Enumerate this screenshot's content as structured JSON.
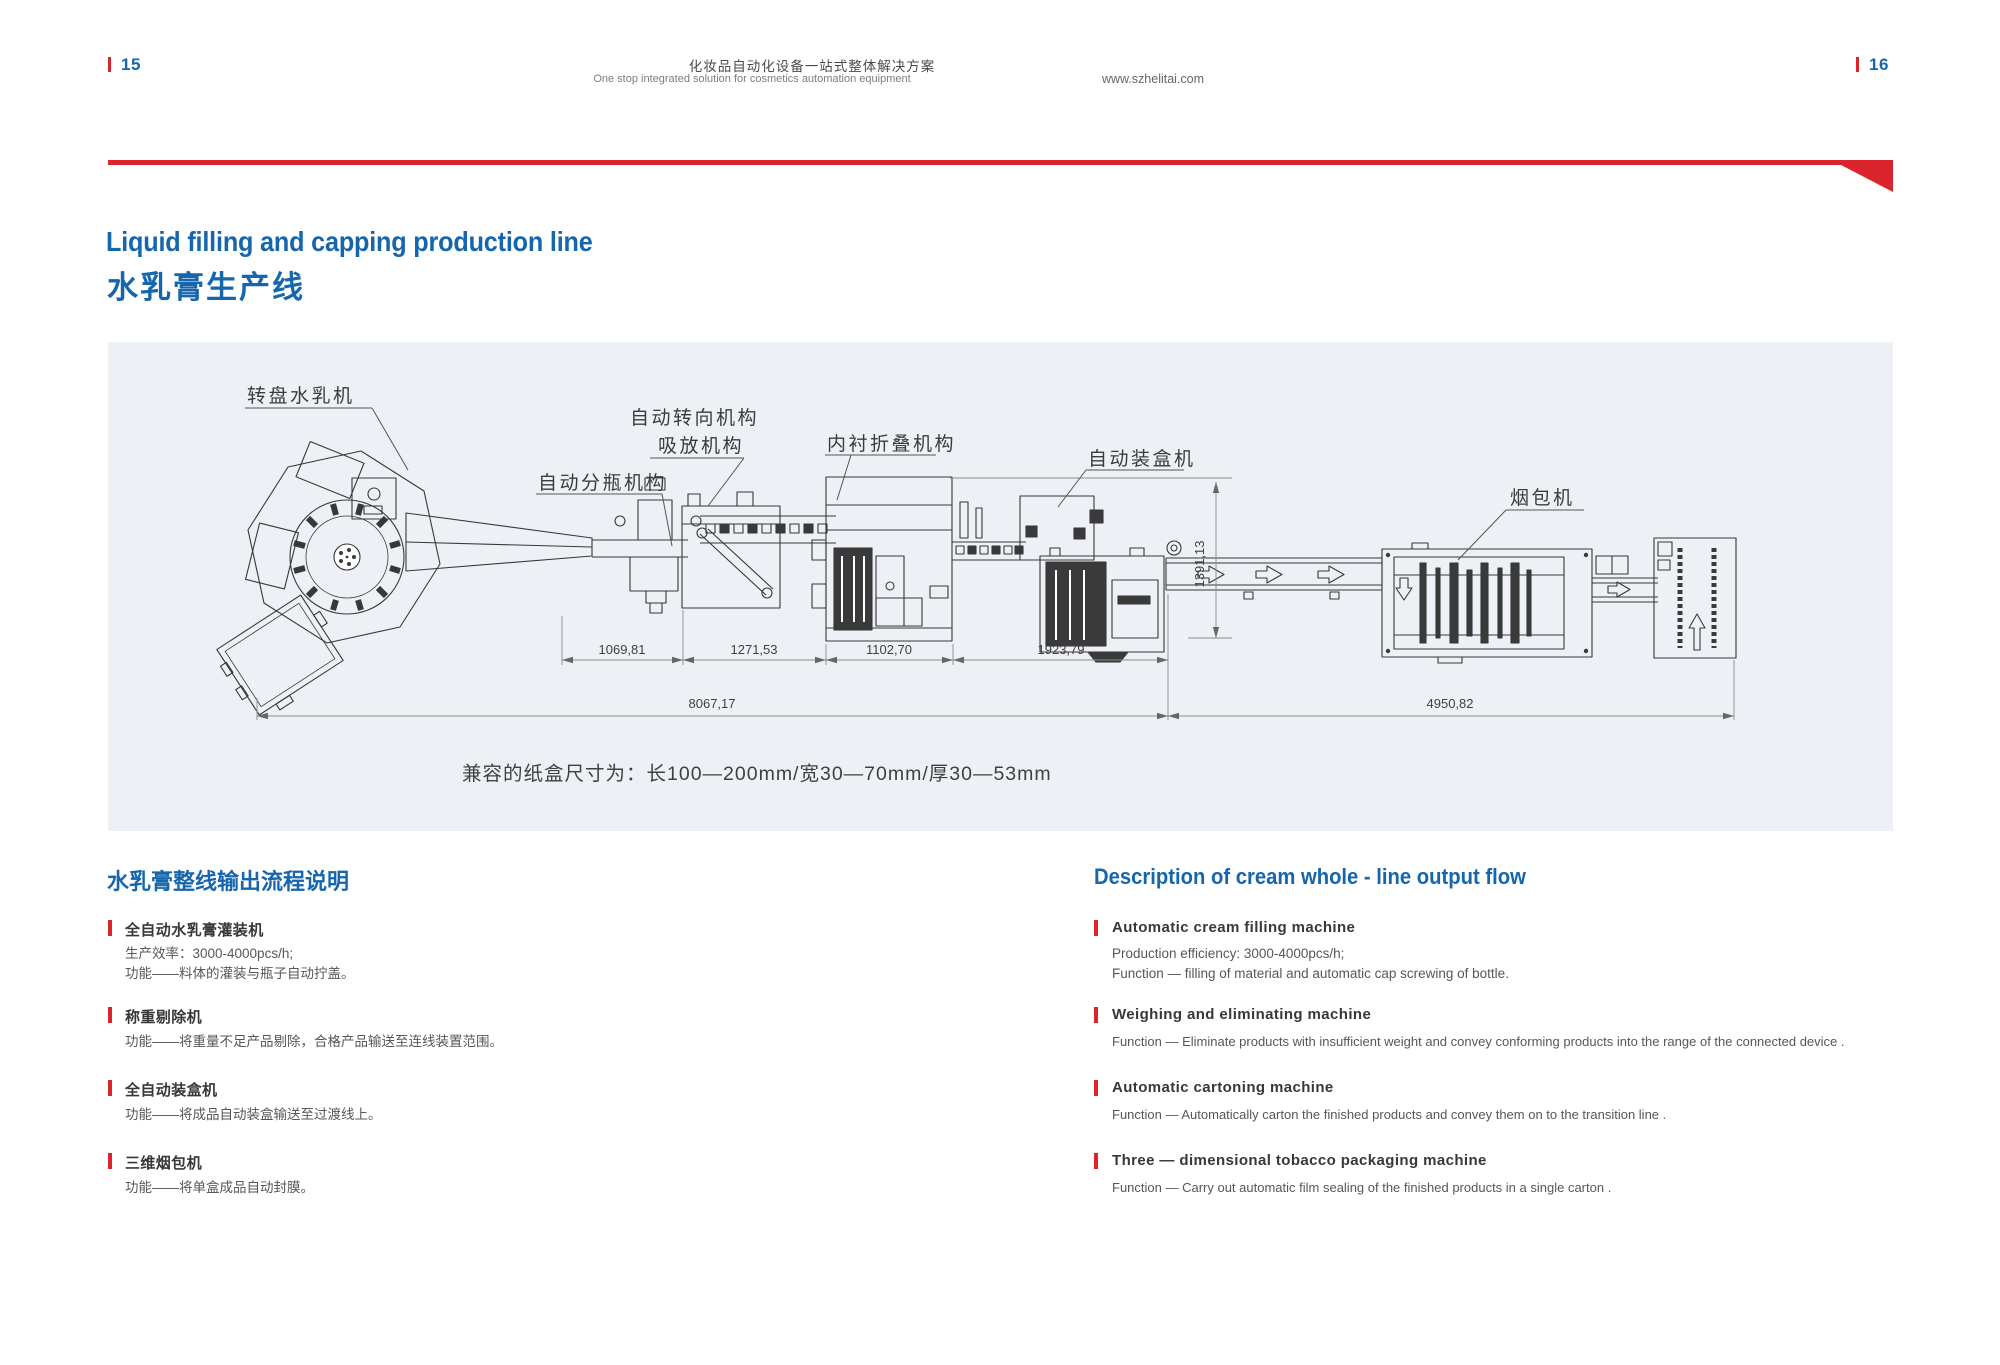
{
  "header": {
    "page_left": "15",
    "page_right": "16",
    "title_cn": "化妆品自动化设备一站式整体解决方案",
    "title_en": "One stop integrated solution for cosmetics automation equipment",
    "website": "www.szhelitai.com"
  },
  "hero": {
    "title_en": "Liquid filling and capping production line",
    "title_cn": "水乳膏生产线"
  },
  "diagram": {
    "labels": {
      "turntable": "转盘水乳机",
      "steering": "自动转向机构",
      "suction": "吸放机构",
      "bottle_divider": "自动分瓶机构",
      "liner_folding": "内衬折叠机构",
      "cartoning": "自动装盒机",
      "tobacco": "烟包机"
    },
    "dims": {
      "d1": "1069,81",
      "d2": "1271,53",
      "d3": "1102,70",
      "d4": "1923,79",
      "d5": "8067,17",
      "d6": "4950,82",
      "d7": "1391,13"
    },
    "caption": "兼容的纸盒尺寸为：长100—200mm/宽30—70mm/厚30—53mm"
  },
  "sections": {
    "cn": {
      "title": "水乳膏整线输出流程说明",
      "items": [
        {
          "title": "全自动水乳膏灌装机",
          "line1": "生产效率：3000-4000pcs/h;",
          "line2": "功能——料体的灌装与瓶子自动拧盖。"
        },
        {
          "title": "称重剔除机",
          "line1": "功能——将重量不足产品剔除，合格产品输送至连线装置范围。",
          "line2": ""
        },
        {
          "title": "全自动装盒机",
          "line1": "功能——将成品自动装盒输送至过渡线上。",
          "line2": ""
        },
        {
          "title": "三维烟包机",
          "line1": "功能——将单盒成品自动封膜。",
          "line2": ""
        }
      ]
    },
    "en": {
      "title": "Description of cream whole - line output flow",
      "items": [
        {
          "title": "Automatic cream filling machine",
          "line1": "Production efficiency: 3000-4000pcs/h;",
          "line2": "Function — filling of material and automatic cap screwing of bottle."
        },
        {
          "title": "Weighing and eliminating machine",
          "line1": "Function — Eliminate products with insufficient weight and convey conforming products into the range of the connected device .",
          "line2": ""
        },
        {
          "title": "Automatic cartoning machine",
          "line1": "Function — Automatically carton the finished products and convey them on to the transition line .",
          "line2": ""
        },
        {
          "title": "Three — dimensional tobacco packaging machine",
          "line1": "Function — Carry out automatic film sealing of the finished products in a single carton .",
          "line2": ""
        }
      ]
    }
  },
  "colors": {
    "accent_blue": "#1566ad",
    "accent_red": "#d9252b",
    "panel_bg": "#edf1f6"
  }
}
